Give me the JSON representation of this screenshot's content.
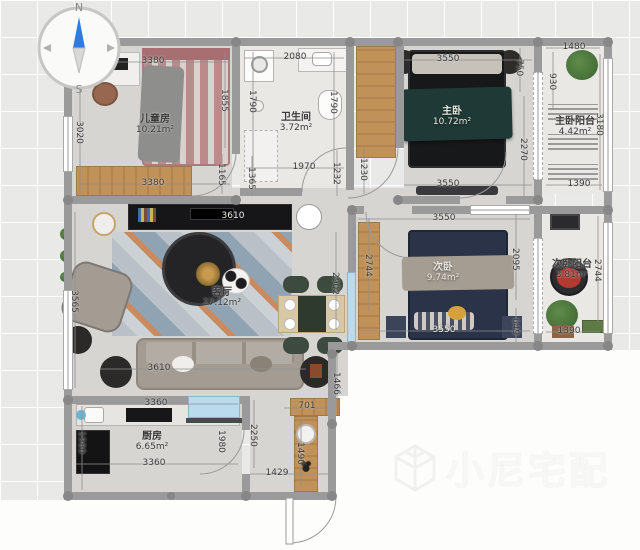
{
  "compass": {
    "north": "N",
    "south": "S"
  },
  "watermark": {
    "brand": "小尼宅配"
  },
  "rooms": {
    "children": {
      "name": "儿童房",
      "area": "10.21m²"
    },
    "bathroom": {
      "name": "卫生间",
      "area": "3.72m²"
    },
    "master": {
      "name": "主卧",
      "area": "10.72m²"
    },
    "master_balcony": {
      "name": "主卧阳台",
      "area": "4.42m²"
    },
    "second": {
      "name": "次卧",
      "area": "9.74m²"
    },
    "second_balcony": {
      "name": "次卧阳台",
      "area": "3.81m²"
    },
    "living": {
      "name": "客厅",
      "area": "27.12m²"
    },
    "kitchen": {
      "name": "厨房",
      "area": "6.65m²"
    }
  },
  "dimensions": {
    "children_top": "3380",
    "children_left": "3020",
    "children_bottom": "3380",
    "children_right": "1855",
    "children_door": "1165",
    "bath_top": "2080",
    "bath_left": "1790",
    "bath_right": "1790",
    "bath_bottom": "1970",
    "hall_left": "1365",
    "hall_right": "1232",
    "master_door": "1230",
    "hall_bottom": "1466",
    "master_top": "3550",
    "master_bottom": "3550",
    "master_right": "2270",
    "master_nook": "750",
    "mbalcony_top": "1480",
    "mbalcony_left": "930",
    "mbalcony_right": "3180",
    "mbalcony_bottom": "1390",
    "second_top": "3550",
    "second_bottom": "3550",
    "second_left": "2744",
    "second_right": "2095",
    "second_gap": "649",
    "sbalcony_right": "2744",
    "sbalcony_bottom": "1390",
    "tv_wall": "3610",
    "sofa": "3610",
    "living_left": "3565",
    "dining_side": "2902",
    "kitchen_top": "3360",
    "kitchen_bottom": "3360",
    "kitchen_left": "1980",
    "kitchen_right": "1980",
    "entry_height": "2250",
    "entry_width": "1429",
    "shoe_top": "701",
    "shoe_side": "1490"
  },
  "colors": {
    "canvas": "#e9e9e8",
    "wall": "#9a9a9a",
    "wall_dot": "#878787",
    "floor": "#d6d5d2",
    "floor_light": "#eae8e5",
    "wood": "#c09158",
    "tv_cabinet": "#161618",
    "master_bed": "#1f3a36",
    "second_bed": "#2a3347",
    "child_bed": "#bb8a8b",
    "sofa": "#a49c93",
    "rug_orange": "#c98a5f",
    "rug_blue": "#8fa3b3",
    "dining_chair": "#3d4a3f",
    "glass_blue": "#badbed",
    "pet_bed": "#b23a33",
    "plant": "#477039",
    "compass_needle": "#2e7ce0",
    "dim_text": "#3c3c3c",
    "watermark": "#f2f2f0"
  }
}
